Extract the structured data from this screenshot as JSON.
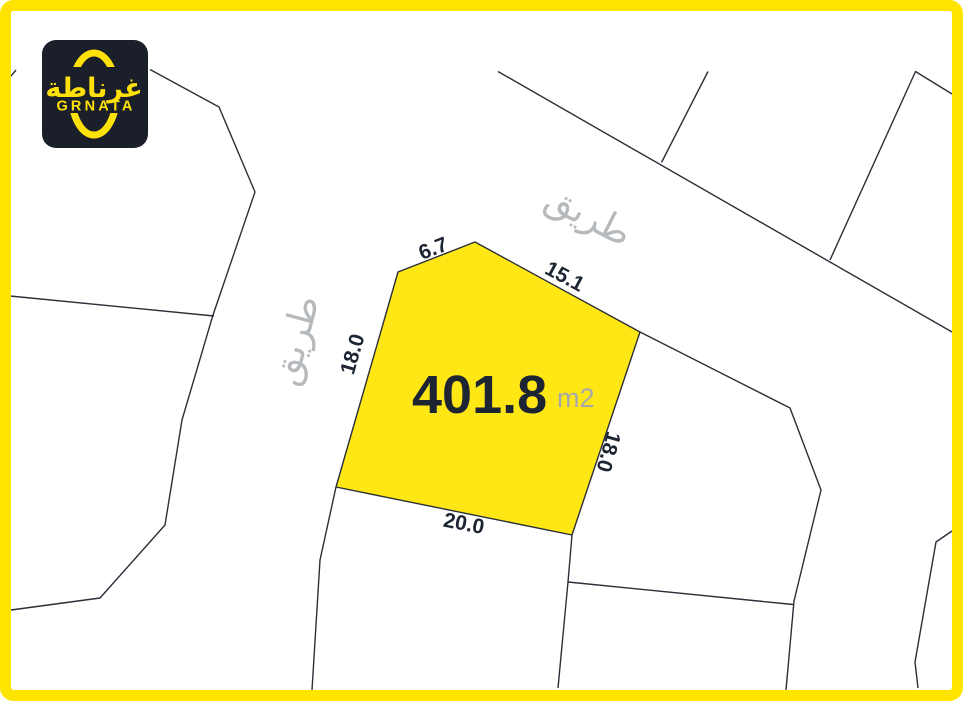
{
  "colors": {
    "frame_yellow": "#FFE400",
    "plot_fill": "#FFE716",
    "line_color": "#2A2F38",
    "dimension_text": "#1D2533",
    "area_text": "#1D2533",
    "unit_text": "#A5A8AA",
    "road_text": "#B7BABD",
    "logo_bg": "#1A1F2A",
    "logo_accent": "#FFE10A"
  },
  "logo": {
    "arabic_name": "غرناطة",
    "latin_name": "GRNATA"
  },
  "plot": {
    "area_value": "401.8",
    "area_unit": "m2",
    "dimensions": {
      "top_left": "6.7",
      "top_right": "15.1",
      "left": "18.0",
      "right": "18.0",
      "bottom": "20.0"
    }
  },
  "roads": {
    "top_label": "طريق",
    "left_label": "طريق"
  }
}
